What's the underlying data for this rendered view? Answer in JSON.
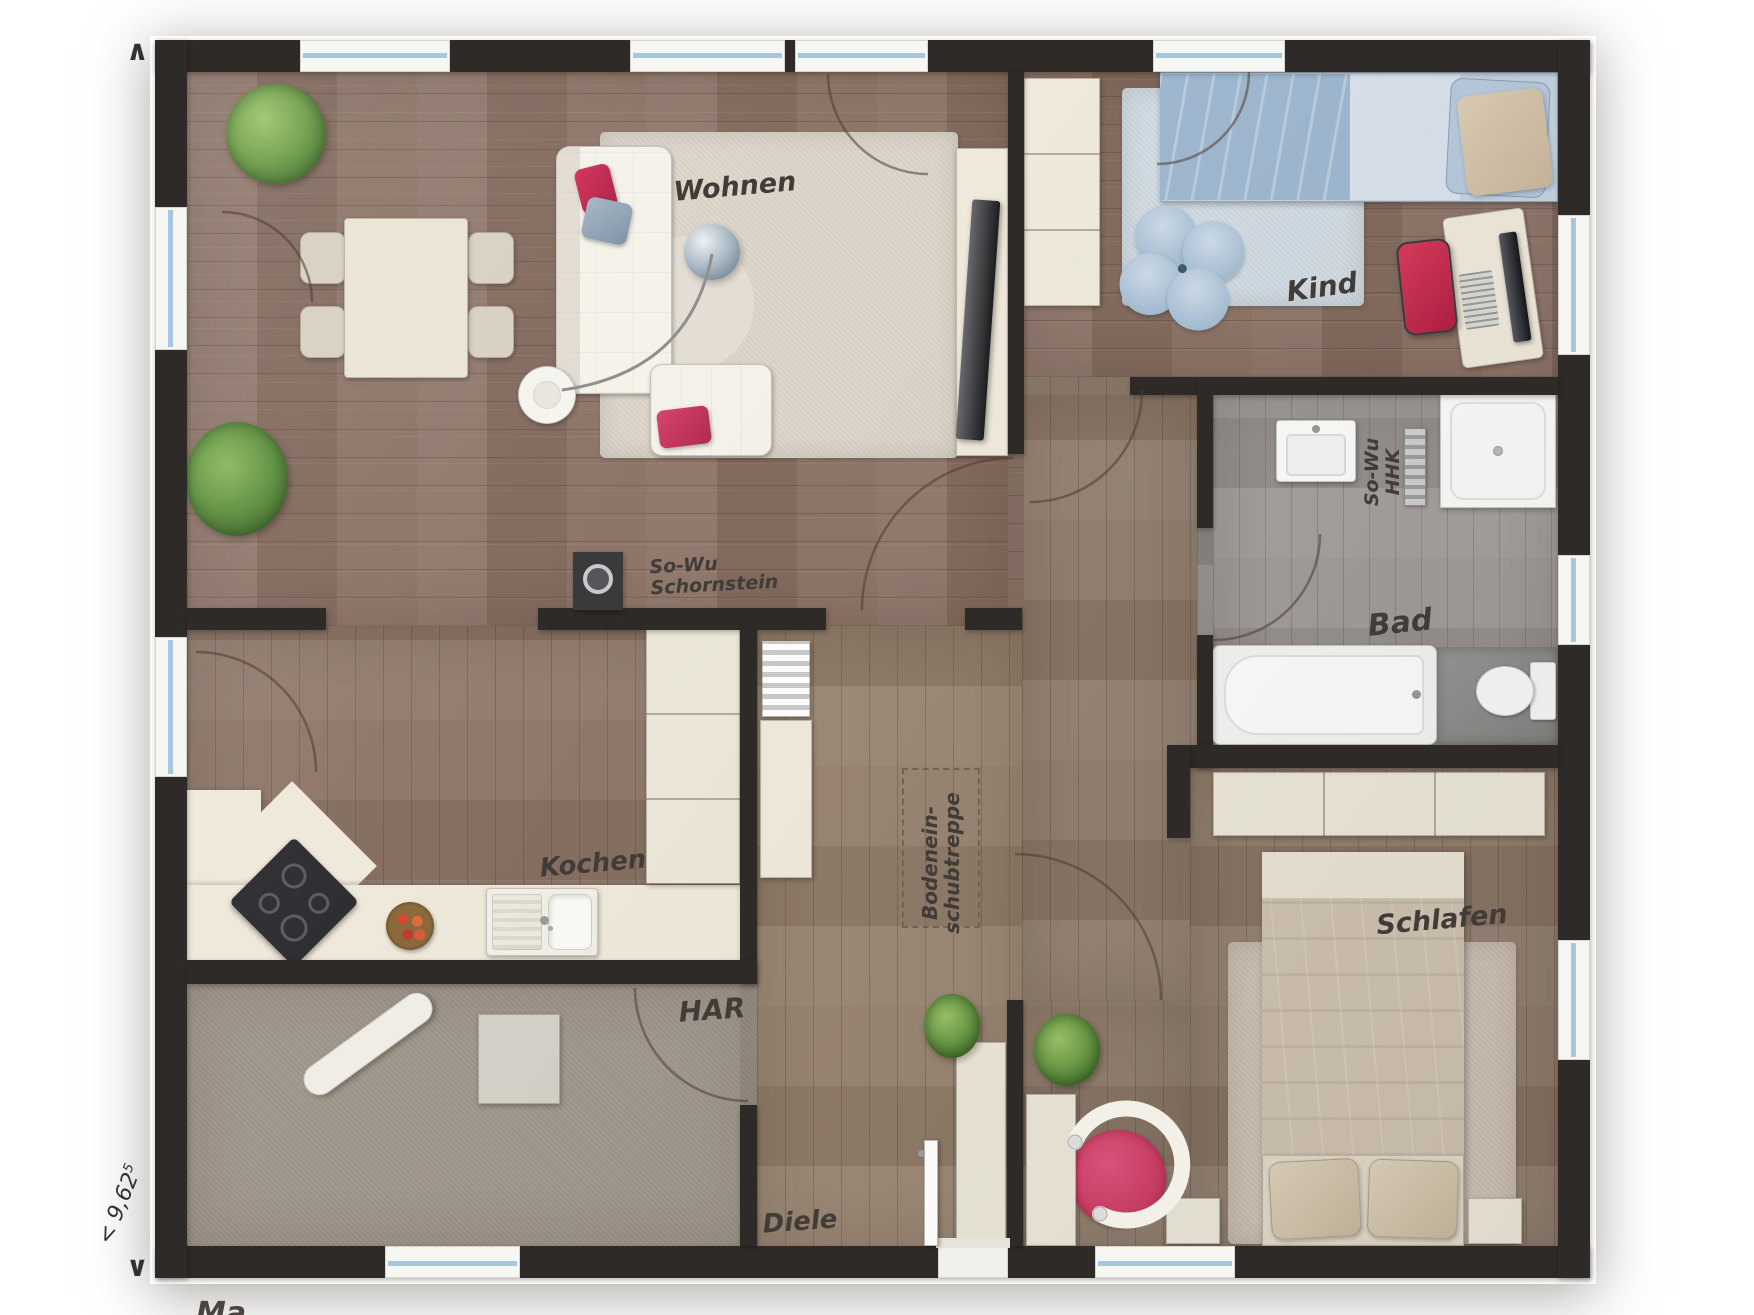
{
  "plan": {
    "rooms": {
      "wohnen": "Wohnen",
      "kind": "Kind",
      "bad": "Bad",
      "kochen": "Kochen",
      "har": "HAR",
      "diele": "Diele",
      "schlafen": "Schlafen"
    },
    "annotations": {
      "chimney_line1": "So-Wu",
      "chimney_line2": "Schornstein",
      "hhk_line1": "So-Wu",
      "hhk_line2": "HHK",
      "attic_line1": "Bodenein-",
      "attic_line2": "schubtreppe"
    },
    "dimensions": {
      "width_value": "< 9,62",
      "width_sup": "5",
      "arrow_top": "∧",
      "arrow_bottom": "∨",
      "cutoff_text": "Ma"
    },
    "palette": {
      "wall": "#2d2a27",
      "wood_warm": "#8b7265",
      "wood_light": "#93806f",
      "wood_gray": "#9f9a97",
      "floor_cream": "#efe9da",
      "floor_har": "#a59c90",
      "furniture_cream": "#ece7d8",
      "glass_blue": "#a7c7df",
      "accent_pink": "#d6456b",
      "accent_blue": "#a9c3d9",
      "plant_green": "#5f8f3e",
      "ink": "#3e3a36"
    }
  }
}
